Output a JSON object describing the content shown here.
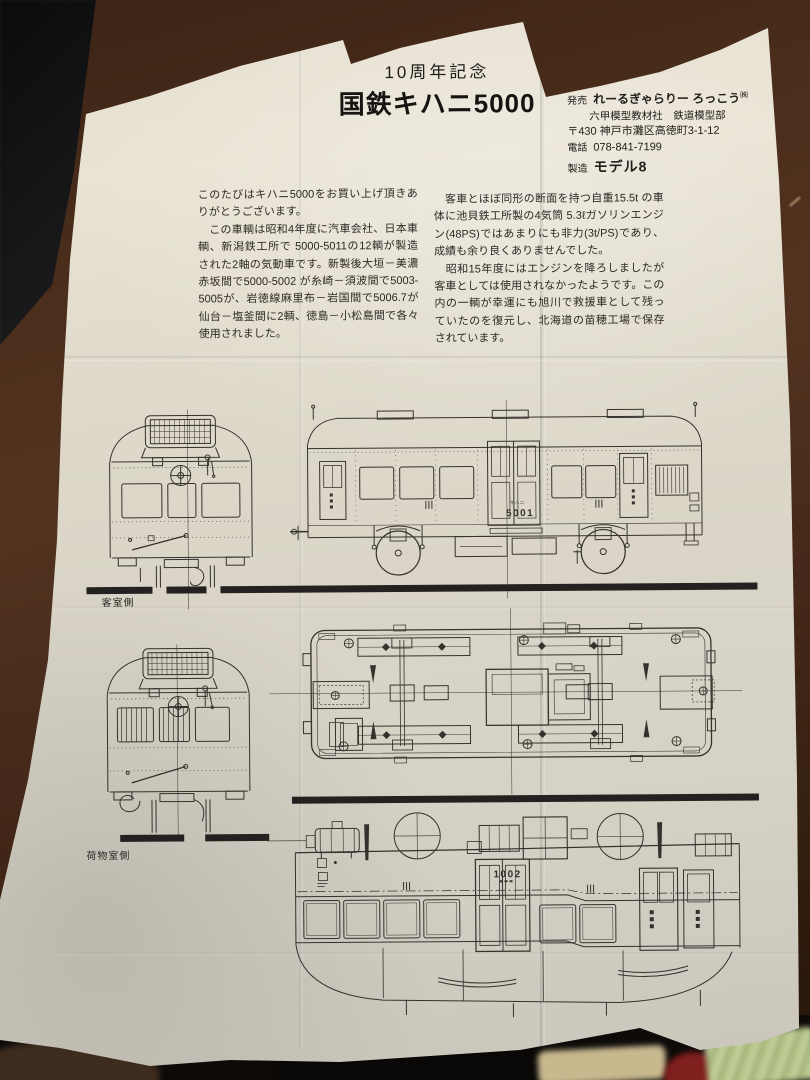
{
  "leaflet": {
    "title": {
      "line1": "10周年記念",
      "line2": "国鉄キハニ5000"
    },
    "publisher": {
      "sale_label": "発売",
      "name": "れーるぎゃらりー ろっこう",
      "name_mark": "㈱",
      "division": "六甲模型教材社　鉄道模型部",
      "address": "〒430 神戸市灘区高徳町3-1-12",
      "tel_label": "電話",
      "tel": "078-841-7199",
      "maker_label": "製造",
      "maker": "モデル8"
    },
    "body_left": "このたびはキハニ5000をお買い上げ頂きありがとうございます。\n　この車輌は昭和4年度に汽車会社、日本車輌、新潟鉄工所で 5000-5011の12輌が製造された2軸の気動車です。新製後大垣－美濃赤坂間で5000-5002 が糸崎－須波間で5003-5005が、岩徳線麻里布－岩国間で5006.7が仙台－塩釜間に2輌、徳島－小松島間で各々使用されました。",
    "body_right": "　客車とほぼ同形の断面を持つ自重15.5t の車体に池貝鉄工所製の4気筒 5.3ℓガソリンエンジン(48PS)ではあまりにも非力(3t/PS)であり、成績も余り良くありませんでした。\n　昭和15年度にはエンジンを降ろしましたが客車としては使用されなかったようです。この内の一輌が幸運にも旭川で救援車として残っていたのを復元し、北海道の苗穂工場で保存されています。",
    "drawings": {
      "front_passenger_label": "客室側",
      "front_baggage_label": "荷物室側",
      "side_series": "キハニ",
      "side_number": "5001",
      "top_number": "1002"
    }
  }
}
